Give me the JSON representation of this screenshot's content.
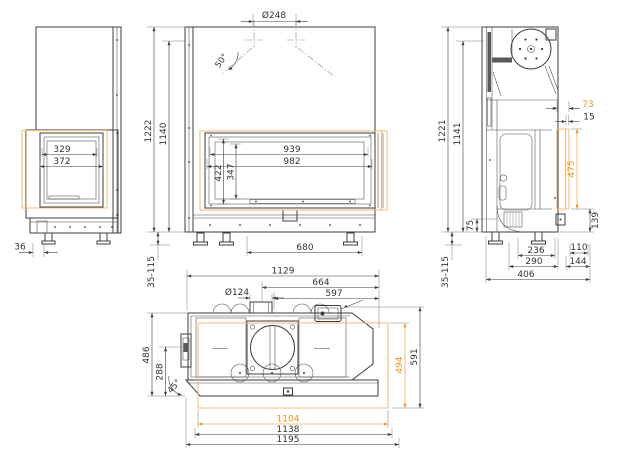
{
  "drawing": {
    "kind": "fireplace-insert-dimension-drawing",
    "colors": {
      "line": "#3d3d3d",
      "accent": "#ef8f1c",
      "accent_light": "#f3ba74",
      "background": "#ffffff"
    },
    "views": {
      "side_view": {
        "glass_width_inner": "329",
        "glass_width_outer": "372",
        "side_offset": "36"
      },
      "front_view": {
        "flue_diameter": "Ø248",
        "hood_angle": "50°",
        "height_total": "1222",
        "height_upper_edge": "1140",
        "glass_width_inner": "939",
        "glass_width_outer": "982",
        "glass_height_outer": "422",
        "glass_height_inner": "347",
        "feet_spacing": "680",
        "feet_adjust_range": "35-115"
      },
      "side_view_right": {
        "height_total": "1221",
        "height_upper_edge": "1141",
        "glass_offset_top": "73",
        "frame_gap": "15",
        "glass_height": "475",
        "plinth_height": "139",
        "duct_height": "75",
        "feet_spacing_depth": "236",
        "depth_mid": "290",
        "depth_total": "406",
        "rear_offset": "110",
        "rear_depth": "144",
        "feet_adjust_range": "35-115"
      },
      "plan_view": {
        "width_rear": "1129",
        "width_mid": "664",
        "flue_center_offset": "597",
        "intake_diameter": "Ø124",
        "depth_body": "486",
        "depth_inner": "288",
        "corner_angle": "45°",
        "glass_depth": "494",
        "depth_total": "591",
        "glass_width": "1104",
        "frame_width_inner": "1138",
        "frame_width": "1195"
      }
    }
  }
}
